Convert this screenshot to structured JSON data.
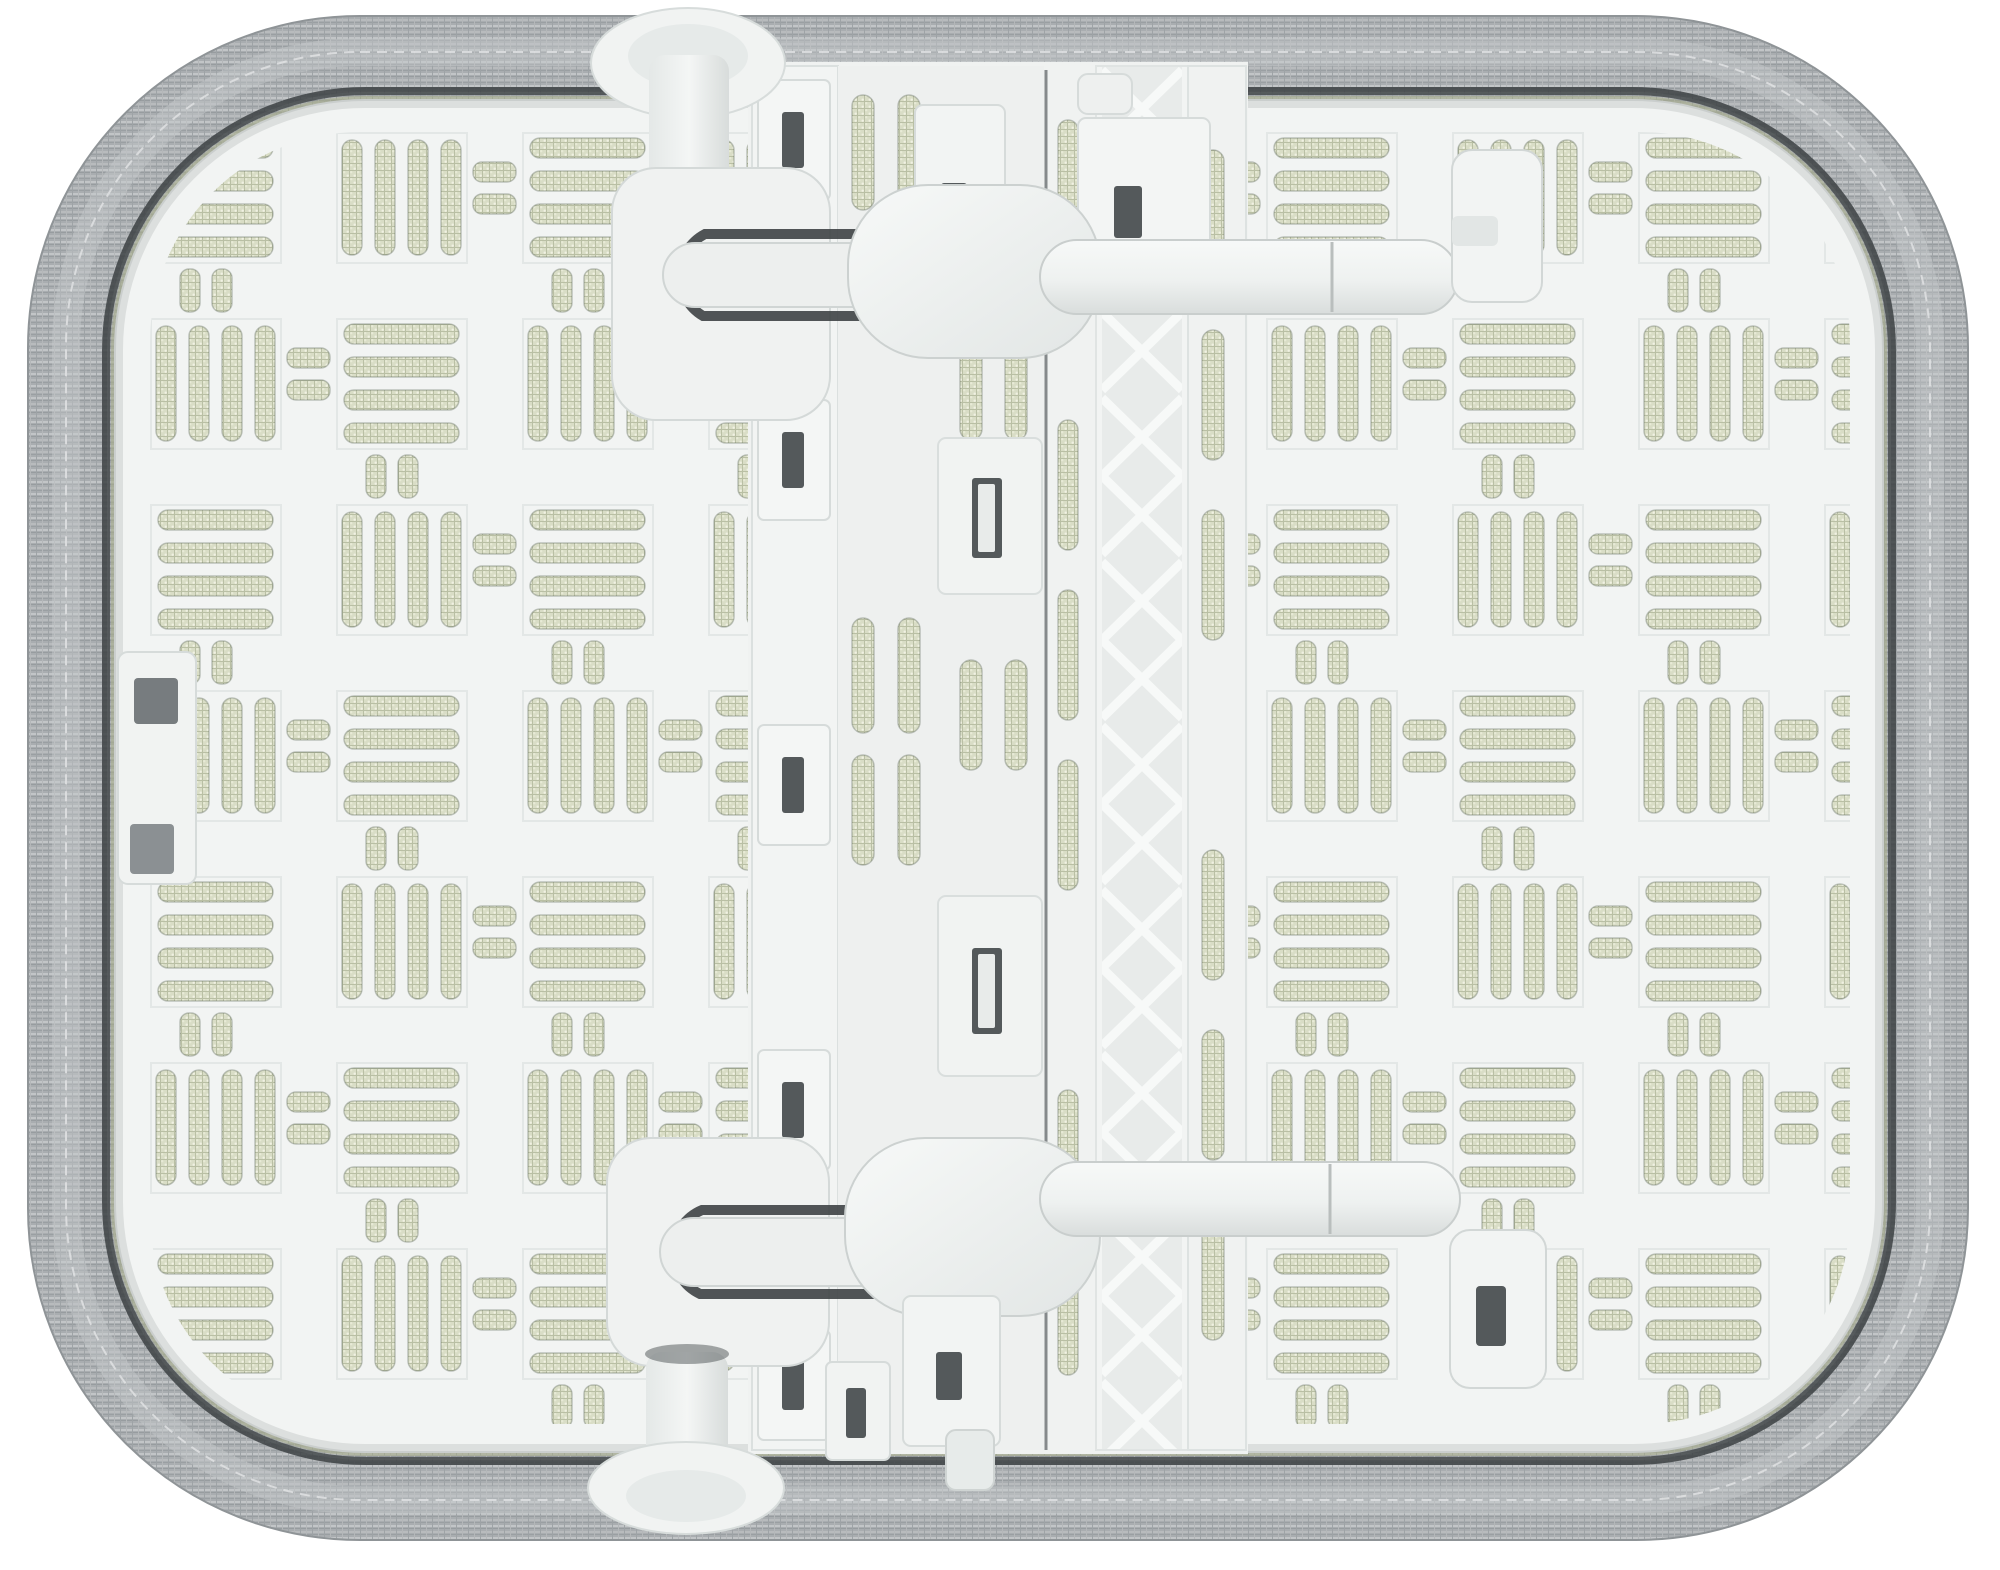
{
  "image": {
    "type": "product-photo",
    "subject": "Underside of a tabletop ironing board with two folding legs",
    "background": "plain white studio background",
    "visible_text": ""
  },
  "colors": {
    "background": "#ffffff",
    "fabric_cover": "#a9adb0",
    "fabric_ridge": "#c6c9cb",
    "fabric_shadow": "#8f9497",
    "cover_seam": "#3c4143",
    "foam_edge": "#b9c093",
    "plastic_base": "#f2f4f3",
    "plastic_bright": "#f7f9f8",
    "plastic_shadow": "#d5dad9",
    "groove": "#e3e7e6",
    "mesh_fill": "#d9ddc6",
    "mesh_dot": "#f0f1e2",
    "mesh_grid": "#b9bfa4",
    "dark_gap": "#3e4345",
    "window_dark": "#54595b",
    "truss_bg": "#e8ebea"
  },
  "parts": {
    "fabric_border": "gray woven fabric cover wrapped over the board edge",
    "cover_seam": "dark gap between cover and plastic shell",
    "plastic_base": "white molded plastic underside shell",
    "vent_grid": "basket-weave grid of mesh-backed vent slots",
    "center_rail": "central channel with X-brace truss rail",
    "latch_plates": "sliding latch plates with rectangular windows",
    "top_leg": "upper folding leg: foot cap, pivot stem, hinge, leg tube, end clip",
    "bottom_leg": "lower folding leg: foot cap, pivot stem, hinge, leg tube, end clip",
    "edge_clip": "cover retaining clip on the left edge"
  }
}
